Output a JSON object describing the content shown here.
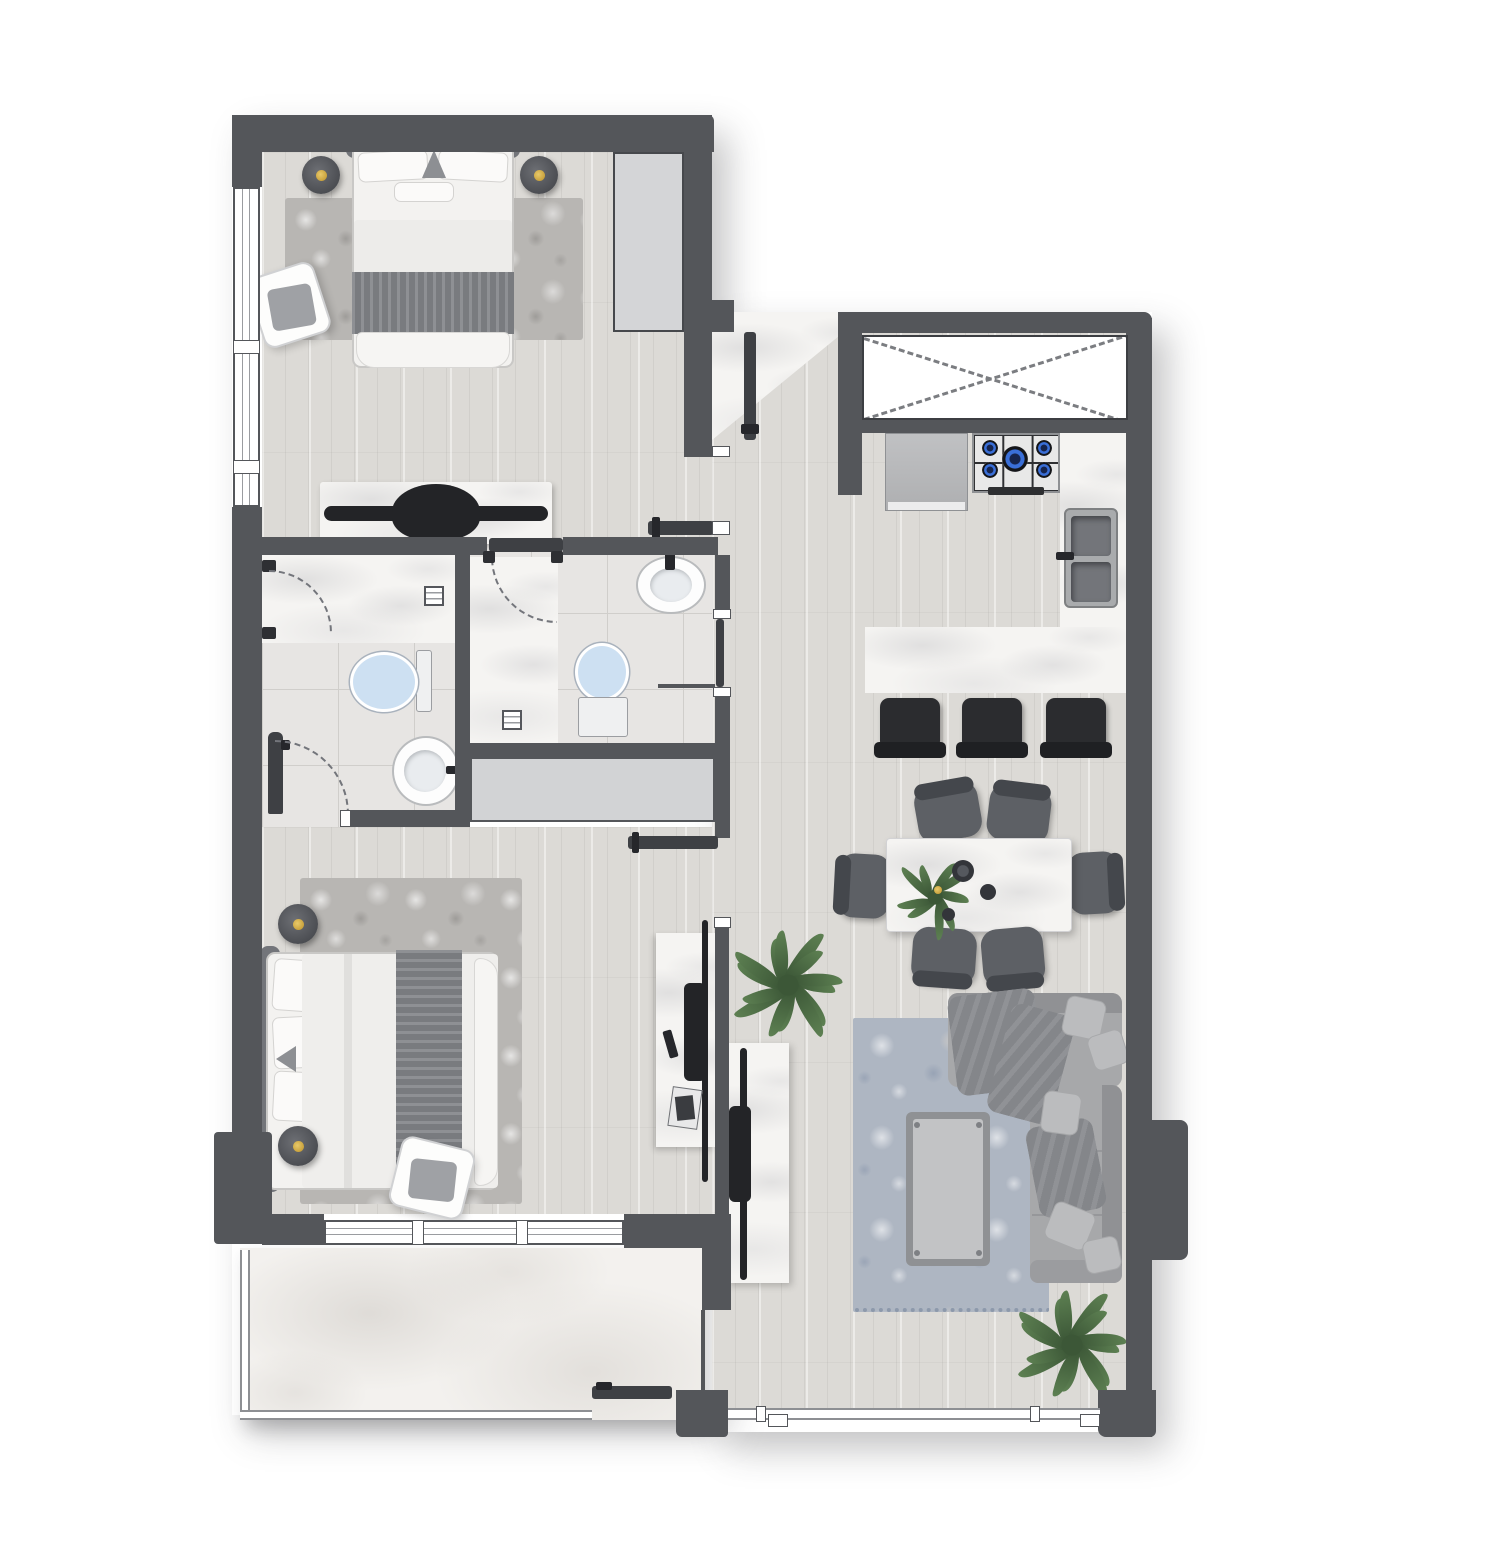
{
  "app": {
    "type": "architectural-floor-plan",
    "view": "top-down 2D rendered apartment plan",
    "visible_text_labels": [],
    "units": "none shown"
  },
  "palette": {
    "wall": "#54565a",
    "wall_dark": "#3e4044",
    "wood": "#dcdad6",
    "tile": "#e7e5e3",
    "tile_line": "#d0cecb",
    "marble": "#f5f4f2",
    "balcony_marble": "#f3f1ee",
    "closet": "#d4d5d7",
    "hall_closet": "#d2d3d5",
    "rug_gray": "#b8b6b3",
    "rug_blue": "#aeb6c2",
    "sofa": "#a7a8aa",
    "sofa_dark": "#909194",
    "throw": "#84868a",
    "bed_white": "#f3f2f0",
    "band_dark": "#797b7f",
    "chair": "#5d6065",
    "chair_dark": "#44474c",
    "stool": "#2b2c2f",
    "toilet_blue": "#cde0f2",
    "gold": "#c9a23d",
    "plant": "#5d8052",
    "plant_dark": "#3c5737",
    "steel": "#a9abad",
    "steel_dark": "#73757a",
    "blue_flame": "#3a6fd8",
    "arc": "#73757b"
  },
  "plants": {
    "hall_leaves": 14,
    "living_leaves": 14,
    "dining_leaves": 9
  },
  "counts": {
    "bedrooms": 2,
    "bathrooms": 2,
    "dining_chairs": 6,
    "bar_stools": 3,
    "hob_burners": 5,
    "bedside_lamps": 4
  },
  "rooms": [
    {
      "id": "bedroom-1",
      "floor": "wood plank",
      "furniture": [
        "double-bed",
        "headboard",
        "bedside-lamp x2",
        "area-rug",
        "accent-pouf",
        "wardrobe-niche",
        "marble-tv-dresser"
      ]
    },
    {
      "id": "bathroom-1",
      "floor": "ceramic tile",
      "fixtures": [
        "marble-walk-in-shower",
        "shower-pivot-door",
        "floor-drain",
        "toilet",
        "pedestal-sink",
        "entry-door"
      ]
    },
    {
      "id": "bathroom-2",
      "floor": "ceramic tile",
      "fixtures": [
        "marble-walk-in-shower",
        "glass-panel",
        "floor-drain",
        "toilet",
        "wall-sink",
        "entry-door"
      ]
    },
    {
      "id": "hallway",
      "floor": "wood plank",
      "features": [
        "storage-closet",
        "potted-plant",
        "back-to-back-tv-consoles"
      ]
    },
    {
      "id": "entry",
      "floor": "marble",
      "features": [
        "entry-door",
        "diagonal-threshold"
      ]
    },
    {
      "id": "kitchen",
      "floor": "wood plank",
      "features": [
        "utility-shaft-x",
        "refrigerator",
        "gas-hob-5-burner",
        "double-bowl-sink",
        "marble-counter",
        "breakfast-bar",
        "bar-stool x3"
      ]
    },
    {
      "id": "dining",
      "floor": "wood plank",
      "furniture": [
        "marble-dining-table",
        "dining-chair x6",
        "table-plant",
        "serving-bowls"
      ]
    },
    {
      "id": "living",
      "floor": "wood plank",
      "furniture": [
        "sectional-sofa",
        "blue-area-rug",
        "coffee-table",
        "marble-tv-console",
        "potted-plant"
      ]
    },
    {
      "id": "master-bedroom",
      "floor": "wood plank",
      "furniture": [
        "double-bed",
        "headboard",
        "bedside-lamp x2",
        "area-rug",
        "accent-pouf",
        "marble-tv-console",
        "sliding-window"
      ]
    },
    {
      "id": "balcony",
      "floor": "marble slab",
      "features": [
        "railing",
        "balcony-door"
      ]
    }
  ]
}
